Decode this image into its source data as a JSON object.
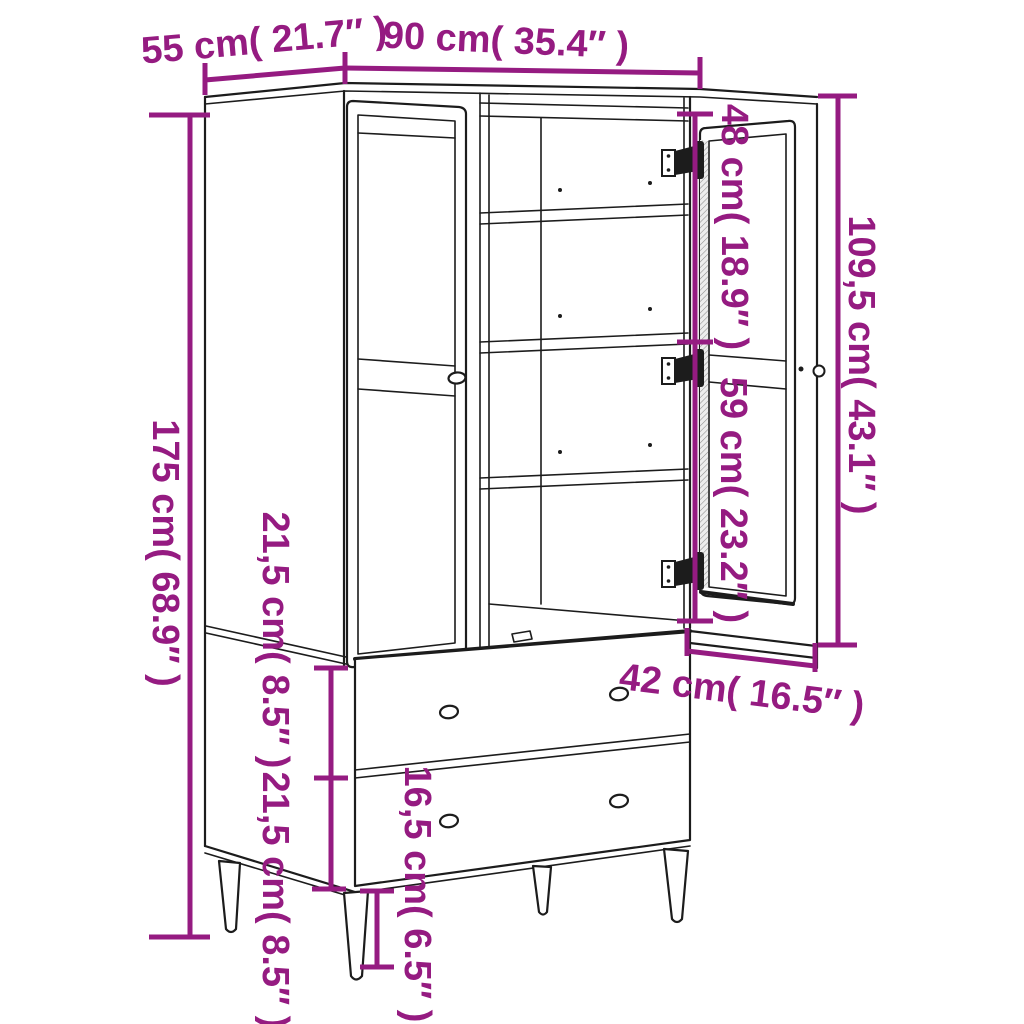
{
  "colors": {
    "accent": "#951b81",
    "line": "#1c1c1c",
    "background": "#ffffff"
  },
  "diagram": {
    "subject": "Wardrobe line drawing with one open door, shelves, two drawers and tapered legs",
    "view": "three-quarter front"
  },
  "dims": [
    {
      "id": "depth-top",
      "label": "55 cm( 21.7″ )"
    },
    {
      "id": "width-top",
      "label": "90 cm( 35.4″ )"
    },
    {
      "id": "overall-height",
      "label": "175 cm( 68.9″ )"
    },
    {
      "id": "upper-compartment",
      "label": "48 cm( 18.9″ )"
    },
    {
      "id": "lower-compartment",
      "label": "59 cm( 23.2″ )"
    },
    {
      "id": "door-height",
      "label": "109,5 cm( 43.1″ )"
    },
    {
      "id": "upper-drawer-height",
      "label": "21,5 cm( 8.5″ )"
    },
    {
      "id": "lower-drawer-height",
      "label": "21,5 cm( 8.5″ )"
    },
    {
      "id": "drawer-top-depth",
      "label": "42 cm( 16.5″ )"
    },
    {
      "id": "leg-height",
      "label": "16,5 cm( 6.5″ )"
    }
  ]
}
